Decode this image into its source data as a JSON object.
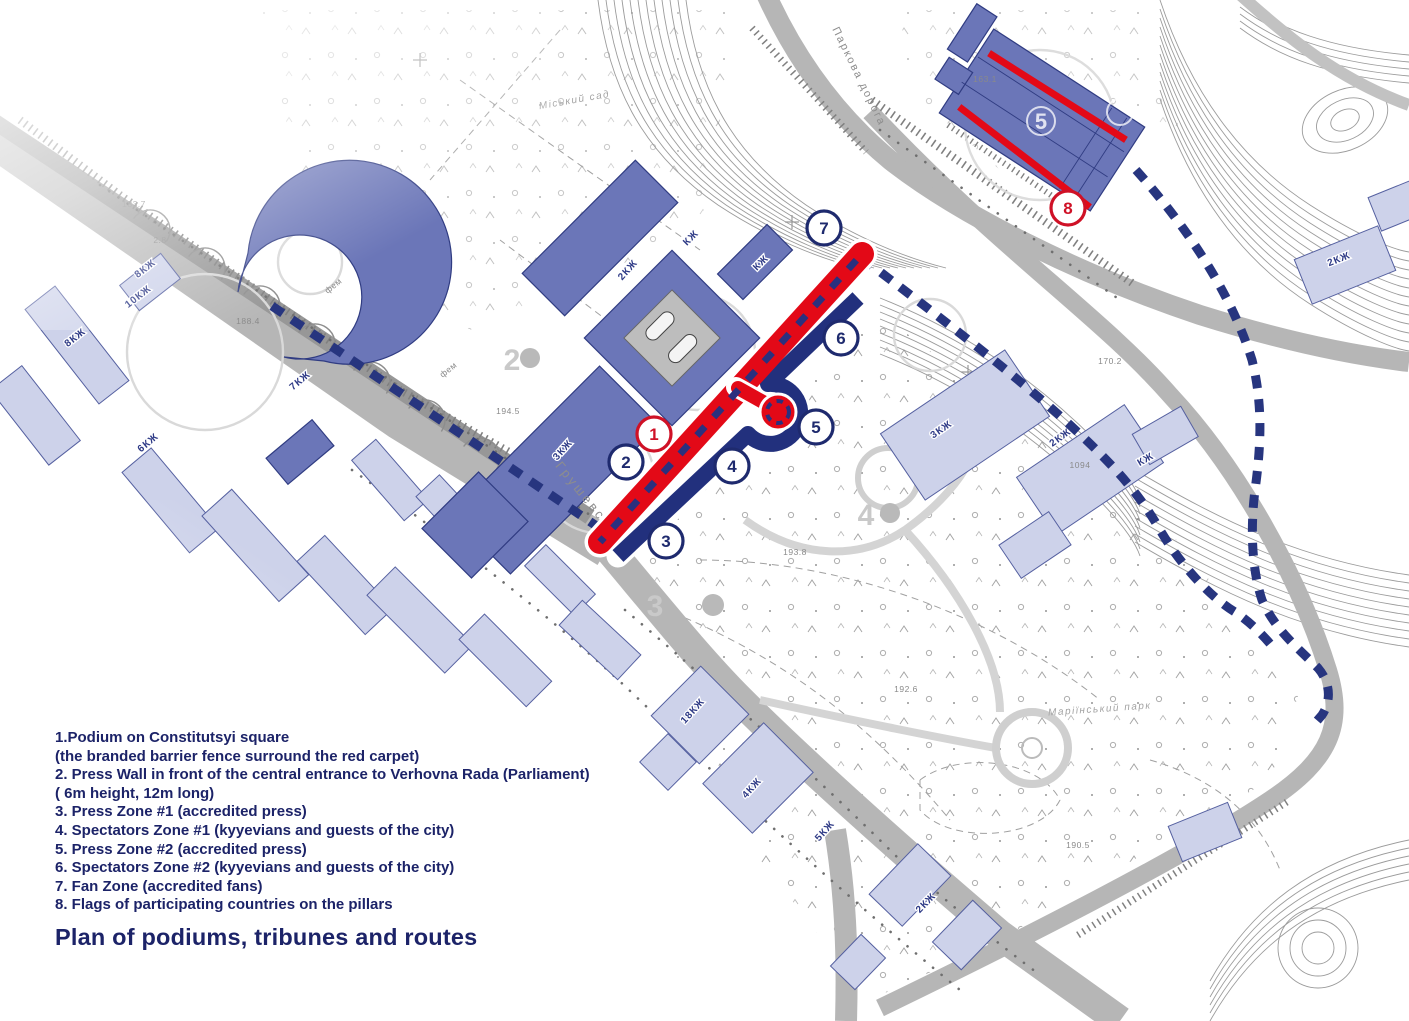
{
  "title": "Plan of podiums, tribunes and routes",
  "legend": {
    "lines": [
      "1.Podium on Constitutsyi square",
      "(the branded barrier fence surround the red carpet)",
      "2. Press Wall in front of the central entrance to Verhovna Rada (Parliament)",
      "( 6m height, 12m long)",
      "3. Press Zone #1 (accredited press)",
      "4. Spectators Zone #1 (kyyevians and guests of the city)",
      "5. Press Zone #2 (accredited press)",
      "6. Spectators Zone #2 (kyyevians and guests of the city)",
      "7. Fan Zone (accredited fans)",
      "8. Flags of participating countries on the pillars"
    ]
  },
  "markers": [
    {
      "number": "1",
      "variant": "red"
    },
    {
      "number": "2",
      "variant": "navy"
    },
    {
      "number": "3",
      "variant": "navy"
    },
    {
      "number": "4",
      "variant": "navy"
    },
    {
      "number": "5",
      "variant": "navy"
    },
    {
      "number": "6",
      "variant": "navy"
    },
    {
      "number": "7",
      "variant": "navy"
    },
    {
      "number": "8",
      "variant": "red"
    }
  ],
  "map_labels": {
    "streets": [
      "Грушевського",
      "Паркова дорога"
    ],
    "areas": [
      "Маріїнський парк",
      "Міський сад"
    ],
    "buildings": [
      "8КЖ",
      "10КЖ",
      "8КЖ",
      "7КЖ",
      "6КЖ",
      "2КЖ",
      "3КЖ",
      "КЖ",
      "КЖ",
      "18КЖ",
      "4КЖ",
      "2КЖ",
      "3КЖ",
      "КЖ",
      "2КЖ",
      "5КЖ",
      "2КЖ"
    ],
    "road_marks": [
      "фем",
      "фем"
    ],
    "elevations": [
      "194.5",
      "193.8",
      "192.6",
      "188.4",
      "183.7",
      "170.2",
      "1094",
      "190.5",
      "2.8",
      "163.1"
    ],
    "ghost_numbers": [
      "2",
      "3",
      "4",
      "5"
    ]
  },
  "colors": {
    "carpet_red": "#e30917",
    "band_navy": "#22307d",
    "route_navy": "#27357f",
    "marker_red": "#cf1126",
    "marker_navy": "#1e2a6e",
    "building_dark": "#6b76b8",
    "building_light": "#cdd2ea",
    "road_gray": "#b5b5b5",
    "text_navy": "#1c2368"
  }
}
